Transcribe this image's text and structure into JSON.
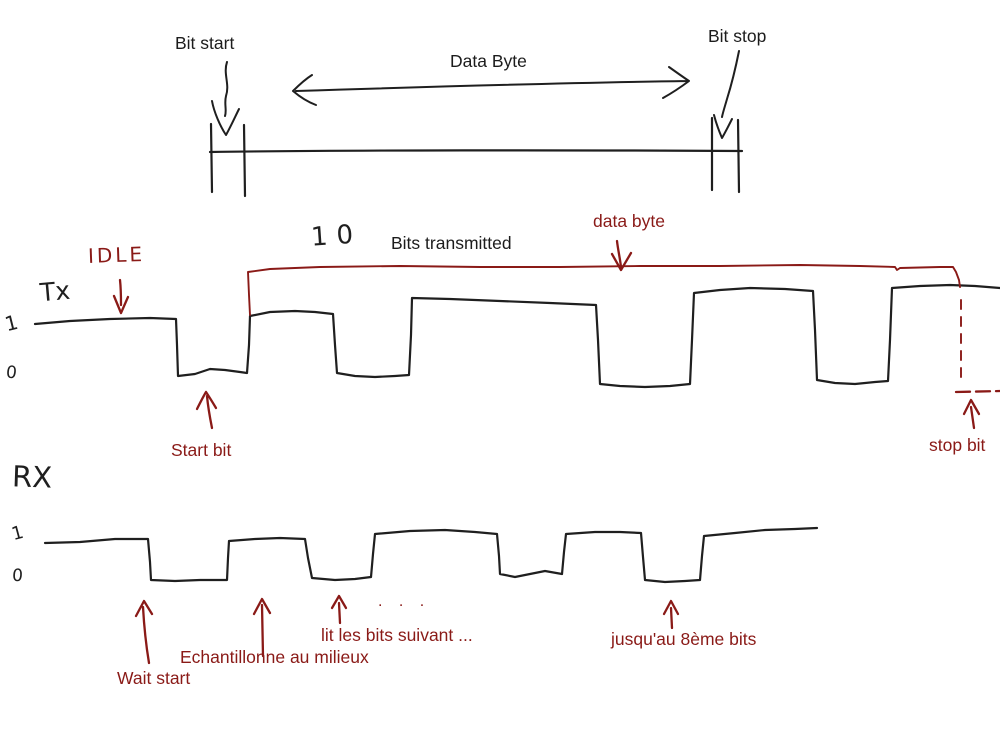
{
  "colors": {
    "ink": "#1f1f1f",
    "accent": "#8a1a17",
    "background": "#ffffff"
  },
  "header": {
    "bit_start": "Bit start",
    "data_byte": "Data Byte",
    "bit_stop": "Bit stop"
  },
  "tx": {
    "idle_label": "IDLE",
    "line_label": "Tx",
    "level_high": "1",
    "level_low": "0",
    "bits_count": "10",
    "bits_transmitted": "Bits transmitted",
    "data_byte_label": "data byte",
    "start_bit_label": "Start bit",
    "stop_bit_label": "stop bit"
  },
  "rx": {
    "line_label": "RX",
    "level_high": "1",
    "level_low": "0",
    "wait_start_label": "Wait start",
    "sample_label": "Echantillonne au milieux",
    "read_next_label": "lit les bits suivant ...",
    "ellipsis": ". . .",
    "until_label": "jusqu'au 8ème bits"
  }
}
